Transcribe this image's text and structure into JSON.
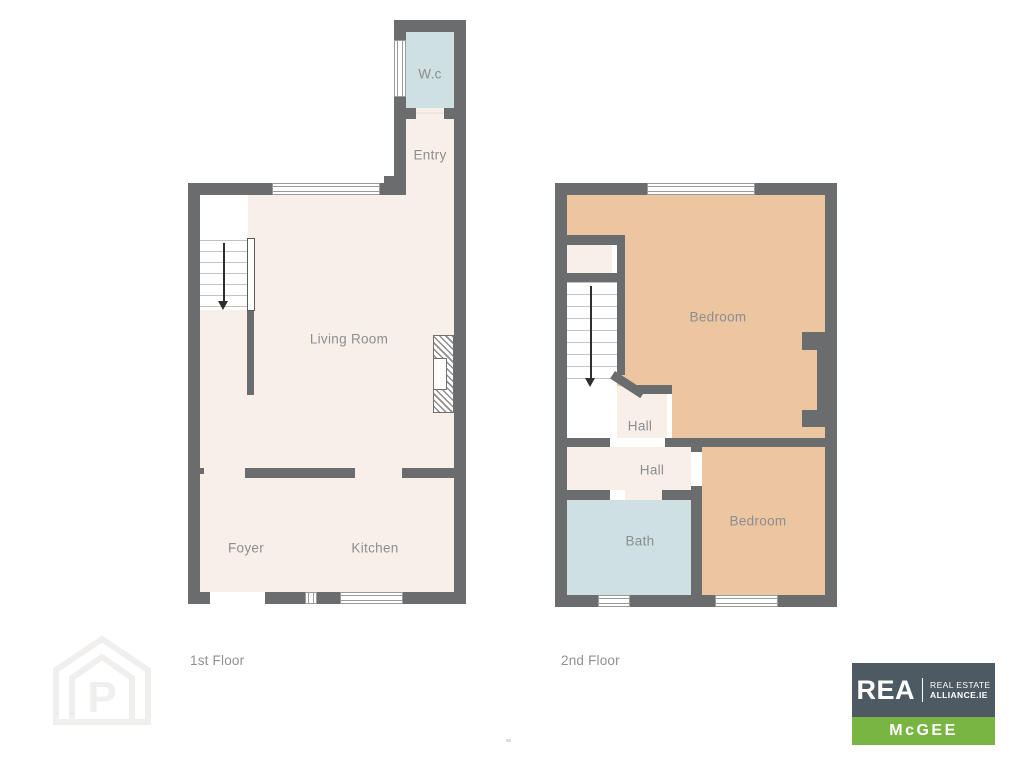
{
  "page": {
    "background": "#ffffff"
  },
  "colors": {
    "wall": "#6b6c6e",
    "floor": "#f8efe9",
    "wet_room": "#cfe0e2",
    "bedroom": "#ecc5a1",
    "stairs": "#ffffff",
    "room_label": "#8b8e90",
    "floor_label": "#8f9194",
    "logo_slate": "#4d5963",
    "logo_green": "#79b543",
    "watermark": "#f1efee"
  },
  "first_floor": {
    "label": "1st Floor",
    "rooms": {
      "wc": "W.c",
      "entry": "Entry",
      "living_room": "Living Room",
      "foyer": "Foyer",
      "kitchen": "Kitchen"
    }
  },
  "second_floor": {
    "label": "2nd Floor",
    "rooms": {
      "bedroom_front": "Bedroom",
      "hall_upper": "Hall",
      "hall_lower": "Hall",
      "bath": "Bath",
      "bedroom_rear": "Bedroom"
    }
  },
  "icons": {
    "stairs_direction": "down-arrow",
    "fireplace": "hatched-chimney-breast",
    "watermark_letter": "P"
  },
  "logo": {
    "brand": "REA",
    "tagline_line1": "REAL ESTATE",
    "tagline_line2": "ALLIANCE.IE",
    "office": "McGEE"
  }
}
